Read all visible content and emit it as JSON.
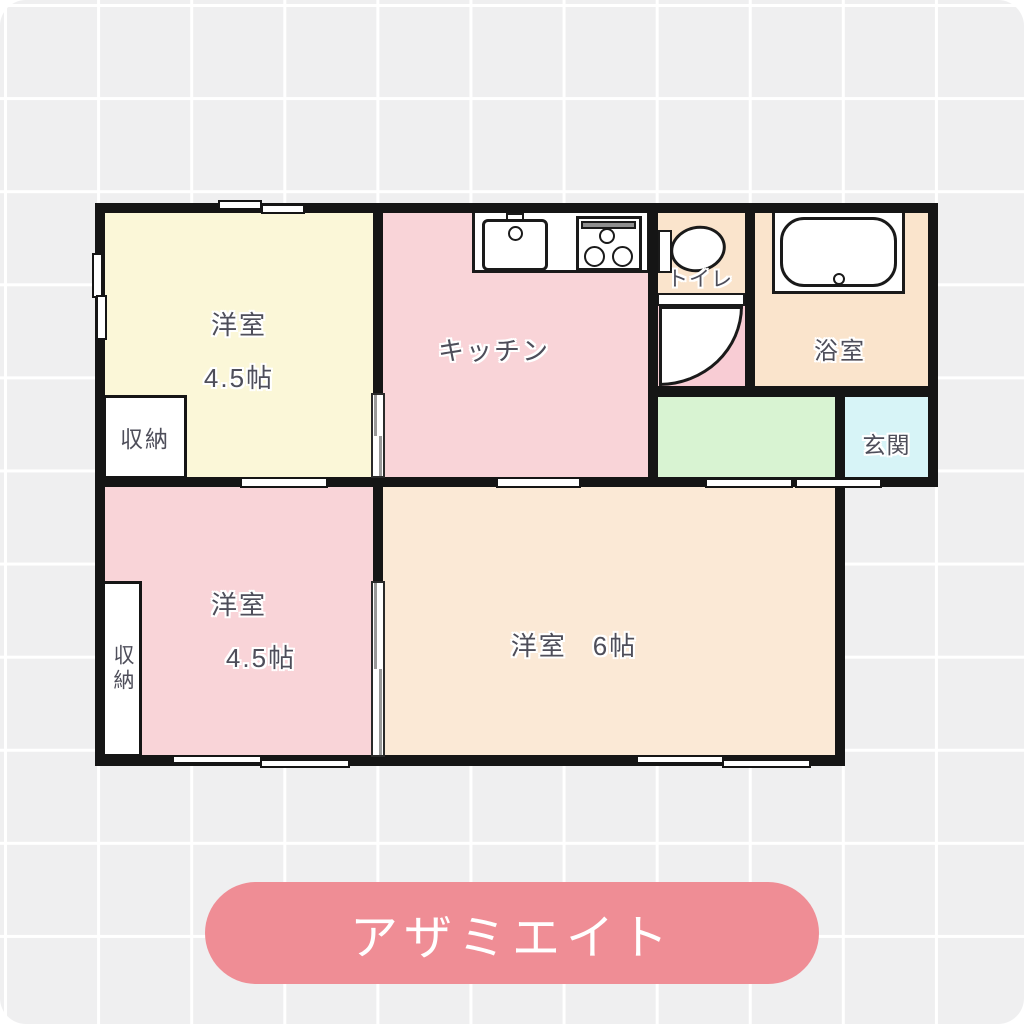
{
  "building": {
    "name": "アザミエイト"
  },
  "rooms": {
    "bedroom_top": {
      "name": "洋室",
      "size": "4.5帖"
    },
    "kitchen": {
      "name": "キッチン"
    },
    "toilet": {
      "name": "トイレ"
    },
    "bathroom": {
      "name": "浴室"
    },
    "entrance": {
      "name": "玄関"
    },
    "bedroom_left": {
      "name": "洋室",
      "size": "4.5帖"
    },
    "bedroom_main": {
      "name": "洋室",
      "size": "6帖"
    },
    "closet_top": {
      "name": "収納"
    },
    "closet_left": {
      "name": "収納"
    }
  },
  "colors": {
    "bedroom_top": "#fbf7d8",
    "kitchen": "#f9d4d8",
    "toilet": "#fae4cc",
    "toilet_door_area": "#f8ccd4",
    "bathroom": "#fae4cc",
    "hallway": "#d8f3d2",
    "entrance": "#d7f4f7",
    "bedroom_left": "#f9d4d8",
    "bedroom_main": "#fbe9d6",
    "wall": "#151515",
    "label_text": "#4e4e5a",
    "title_badge": "#ef8d95",
    "background": "#efeff0"
  }
}
